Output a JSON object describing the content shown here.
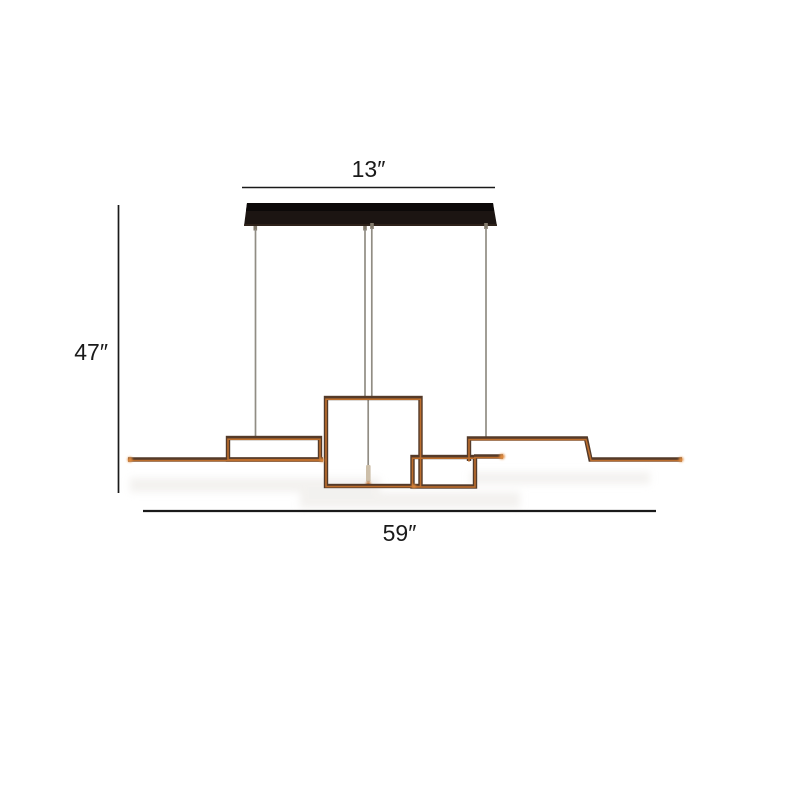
{
  "diagram": {
    "type": "product-dimension-diagram",
    "subject": "linear geometric led island chandelier with ceiling canopy",
    "labels": {
      "canopy_width": "13″",
      "drop_height": "47″",
      "fixture_length": "59″"
    }
  },
  "colors": {
    "background": "#ffffff",
    "annotation": "#1a1a1a",
    "canopy": "#1c1512",
    "canopy-top": "#0c0908",
    "cable": "#918d84",
    "frame-dark": "#543a29",
    "frame-glow": "#c2712e",
    "glow-bright": "#e08a3c",
    "connector": "#cdbfa9",
    "shadow": "#e9e6e2"
  }
}
